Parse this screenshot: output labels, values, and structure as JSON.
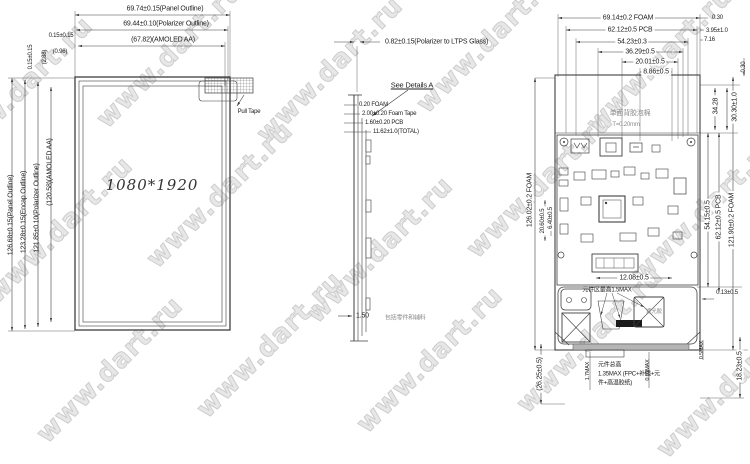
{
  "watermark": {
    "text": "www.dart.ru"
  },
  "colors": {
    "line": "#3f3f3f",
    "watermark": "#cdcdcd",
    "foam_note": "#8a8a8a"
  },
  "left_view": {
    "resolution": "1080*1920",
    "pull_tape_label": "Pull Tape",
    "dims_top": [
      "69.74±0.15(Panel Outline)",
      "69.44±0.10(Polarizer Outline)",
      "(67.82)(AMOLED AA)"
    ],
    "dim_gap_h_1": "0.15±0.15",
    "dim_gap_h_2": "(0.96)",
    "dim_gap_v_1": "0.15±0.15",
    "dim_gap_v_2": "(2.88)",
    "dims_left": [
      "126.68±0.15(Panel Outline)",
      "123.28±0.15(Encap Outline)",
      "121.85±0.10(Polarizer Outline)",
      "(120.58)(AMOLED AA)"
    ]
  },
  "side_view": {
    "dim_polarizer": "0.82±0.15(Polarizer to LTPS Glass)",
    "see_details_label": "See Details A",
    "stack_dims": [
      "0.20 FOAM",
      "2.00±0.20 Foam Tape",
      "1.60±0.20 PCB",
      "11.62±1.0(TOTAL)"
    ],
    "dim_bottom_value": "1.50",
    "dim_bottom_note": "包括零件和辅料"
  },
  "back_view": {
    "foam_note": [
      "单面背胶泡棉",
      "T=0.20mm"
    ],
    "dims_top": [
      "69.14±0.2 FOAM",
      "62.12±0.5 PCB",
      "54.23±0.3",
      "36.29±0.5",
      "20.01±0.5",
      "8.86±0.5"
    ],
    "dims_top_right": [
      "0.30",
      "3.95±1.0",
      "7.16"
    ],
    "dims_right": [
      "0.30",
      "34.28",
      "30.30±1.0",
      "54.15±0.5",
      "62.12±0.5 PCB",
      "121.90±0.2 FOAM",
      "0.13±0.5",
      "18.23±0.5"
    ],
    "dims_left": [
      "126.02±0.2 FOAM",
      "20.60±0.5",
      "6.40±0.5",
      "(26.25±0.5)"
    ],
    "dim_bottom_width": "12.08±0.5",
    "component_area_note": "元件区最高1.5MAX",
    "component_total_note": [
      "元件总高",
      "1.35MAX (FPC+补强+元",
      "件+高温胶纸)"
    ],
    "dim_fpc_max": "1.7MAX",
    "dim_connector_max": "0.65MAX",
    "dim_bar_max": "0.5MAX",
    "shading_tape_label": "遮光胶"
  }
}
